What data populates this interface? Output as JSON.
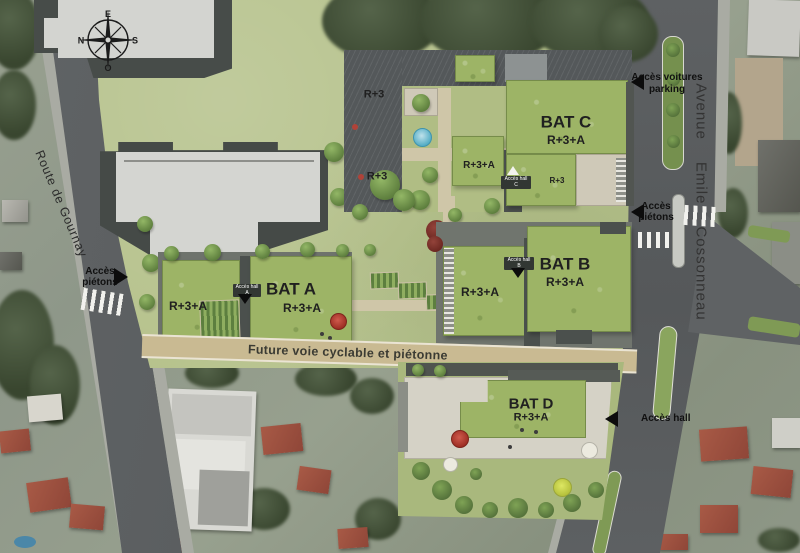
{
  "compass": {
    "east": "E",
    "south": "S",
    "west": "O",
    "north": "N"
  },
  "streets": {
    "route": "Route de Gournay",
    "avenue_word1": "Avenue",
    "avenue_word2": "Emile",
    "avenue_word3": "Cossonneau"
  },
  "cycle_path": {
    "label": "Future voie cyclable et piétonne"
  },
  "access": {
    "pedestrian_left": {
      "line1": "Accès",
      "line2": "piétons"
    },
    "parking": {
      "line1": "Accès voitures",
      "line2": "parking"
    },
    "pedestrian_right": {
      "line1": "Accès",
      "line2": "piétons"
    },
    "hall": {
      "label": "Accès hall"
    },
    "hall_a": {
      "label": "Accès hall A"
    },
    "hall_b": {
      "label": "Accès hall B"
    },
    "hall_c": {
      "label": "Accès hall C"
    }
  },
  "buildings": {
    "bat_a": {
      "name": "BAT A",
      "floors": "R+3+A"
    },
    "bat_b": {
      "name": "BAT B",
      "floors": "R+3+A"
    },
    "bat_c": {
      "name": "BAT C",
      "floors": "R+3+A"
    },
    "bat_d": {
      "name": "BAT D",
      "floors": "R+3+A"
    }
  },
  "floor_tags": {
    "r3": "R+3",
    "r3a": "R+3+A"
  },
  "colors": {
    "lawn": "#b6c28c",
    "green_roof": "#9db466",
    "dark_roof": "#54585a",
    "road": "#5d6062",
    "cycle_path": "#c9ba92",
    "existing_building": "#d4d5d1",
    "red_accent": "#b23a2e",
    "pool_blue": "#56aec6",
    "label_text": "#1d1d1b"
  }
}
